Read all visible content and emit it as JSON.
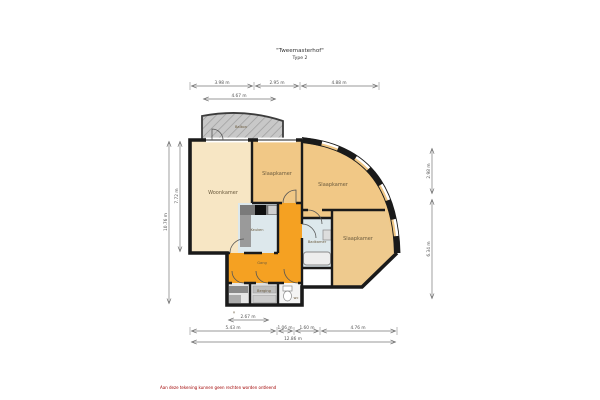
{
  "title": {
    "line1": "\"Tweemasterhof\"",
    "line2": "Type 2"
  },
  "rooms": {
    "balkon": "Balkon",
    "woonkamer": "Woonkamer",
    "slaapkamer_1": "Slaapkamer",
    "slaapkamer_2": "Slaapkamer",
    "slaapkamer_3": "Slaapkamer",
    "keuken": "Keuken",
    "badkamer": "Badkamer",
    "gang": "Gang",
    "berging": "Berging",
    "wc": "wc"
  },
  "dimensions": {
    "top": [
      "3.98 m",
      "2.95 m",
      "4.88 m"
    ],
    "top_inner": "4.67 m",
    "left_outer": "10.76 m",
    "left_inner": "7.72 m",
    "right_top": "2.98 m",
    "right_bottom": "6.34 m",
    "bottom_inner": "2.67 m",
    "bottom_mid": [
      "5.43 m",
      "1.06 m",
      "1.60 m",
      "4.76 m"
    ],
    "bottom_total": "12.86 m"
  },
  "marker": "×",
  "footer": {
    "disclaimer": "Aan deze tekening kunnen geen rechten worden ontleend"
  },
  "colors": {
    "wall": "#1a1a1a",
    "hall": "#f5a122",
    "room": "#f1c886",
    "room_right": "#eeca8e",
    "living": "#f7e6c4",
    "wet": "#dde8ec",
    "balcony": "#c8c8c8"
  }
}
